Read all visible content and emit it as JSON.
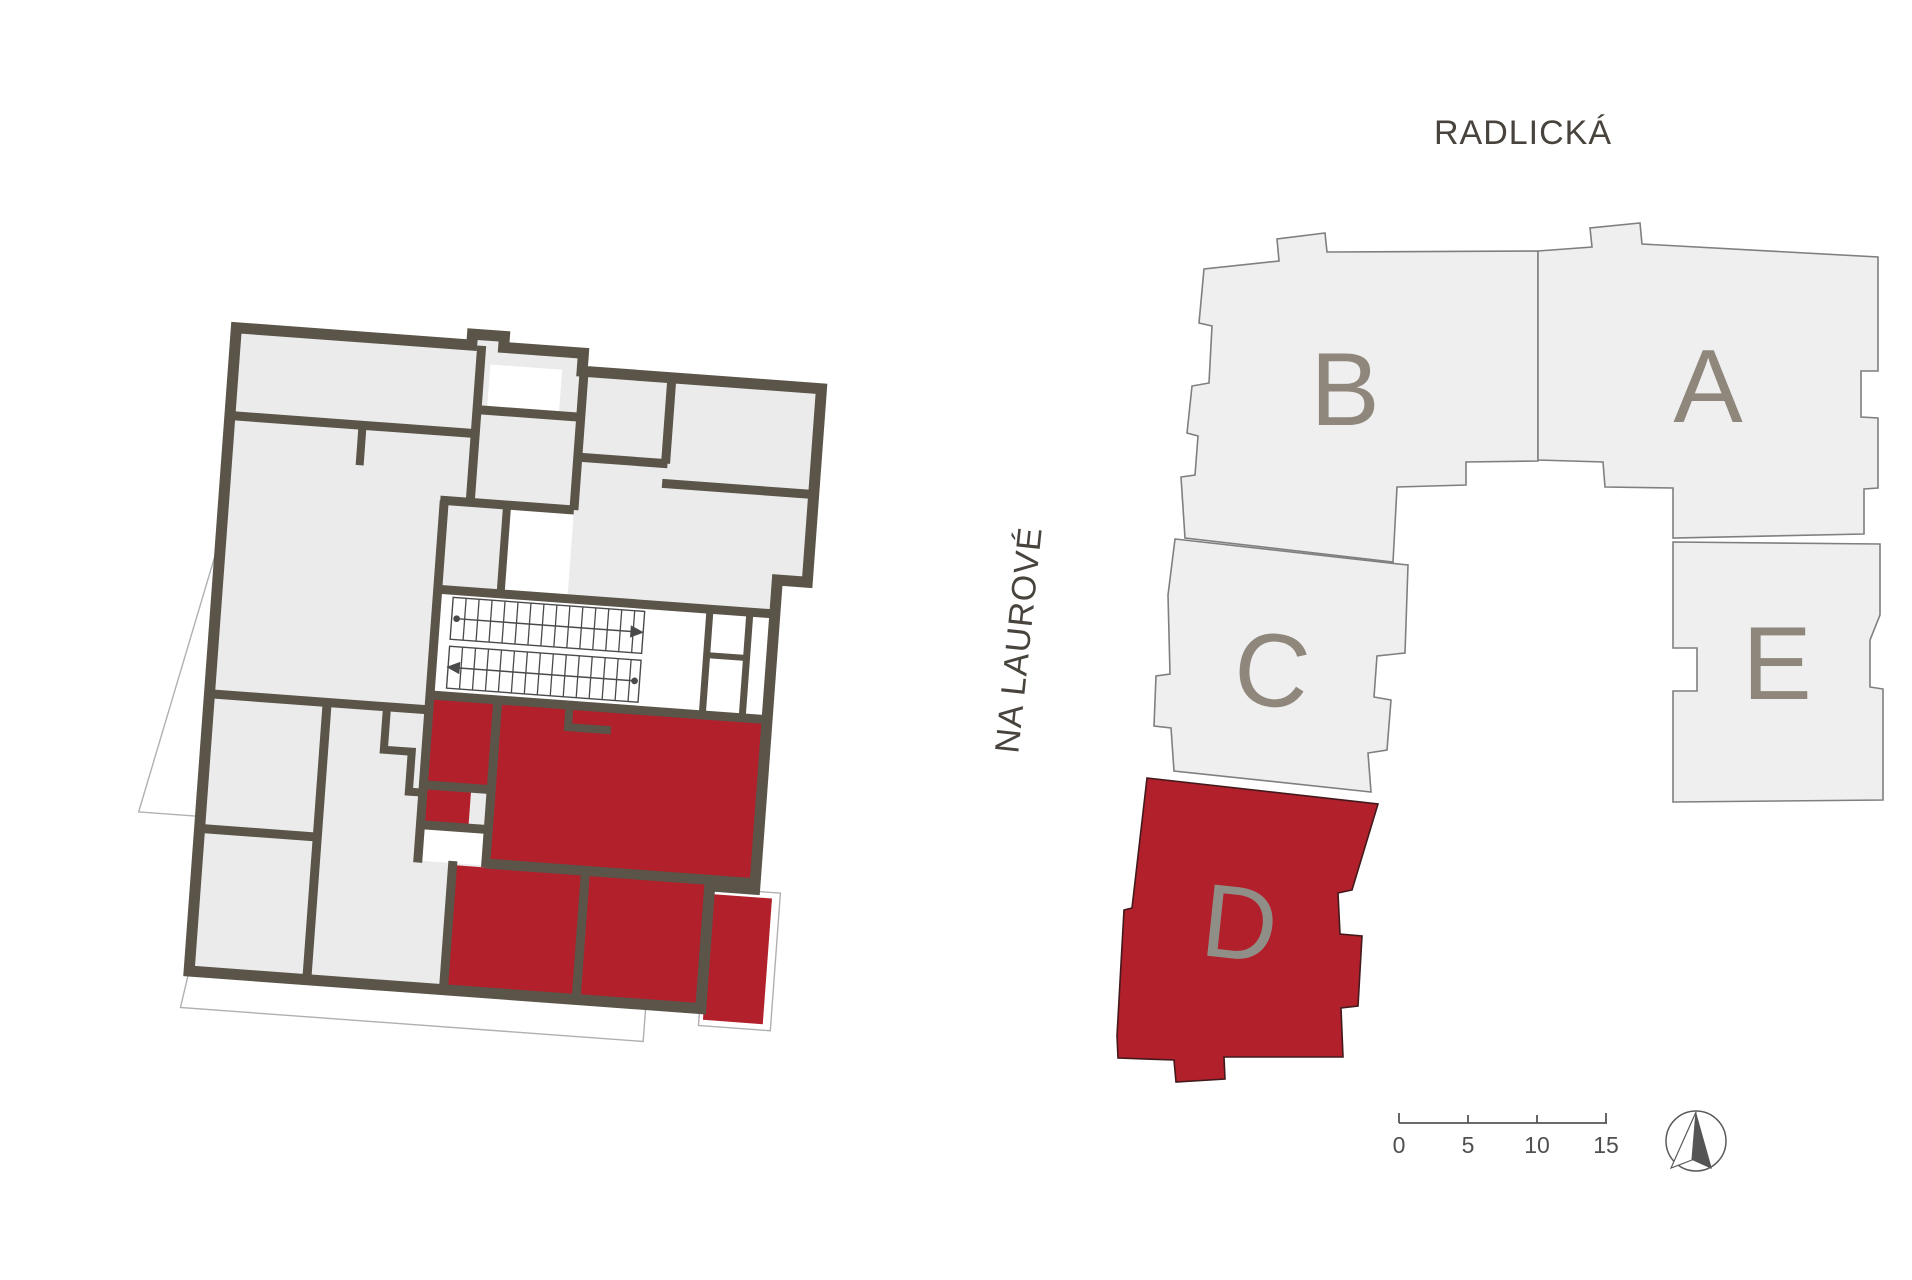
{
  "site_plan": {
    "street_top": "RADLICKÁ",
    "street_left": "NA LAUROVÉ",
    "buildings": [
      {
        "id": "A",
        "label": "A",
        "highlighted": false
      },
      {
        "id": "B",
        "label": "B",
        "highlighted": false
      },
      {
        "id": "C",
        "label": "C",
        "highlighted": false
      },
      {
        "id": "D",
        "label": "D",
        "highlighted": true
      },
      {
        "id": "E",
        "label": "E",
        "highlighted": false
      }
    ],
    "colors": {
      "building_fill": "#efefef",
      "building_outline": "#7f7f7f",
      "highlight_fill": "#b2202b",
      "letter_color": "#8f877c",
      "street_label_color": "#48443d"
    }
  },
  "floor_plan": {
    "wall_color": "#5a5449",
    "room_fill": "#ebebeb",
    "highlight_fill": "#b2202b"
  },
  "scale_bar": {
    "labels": [
      "0",
      "5",
      "10",
      "15"
    ]
  }
}
